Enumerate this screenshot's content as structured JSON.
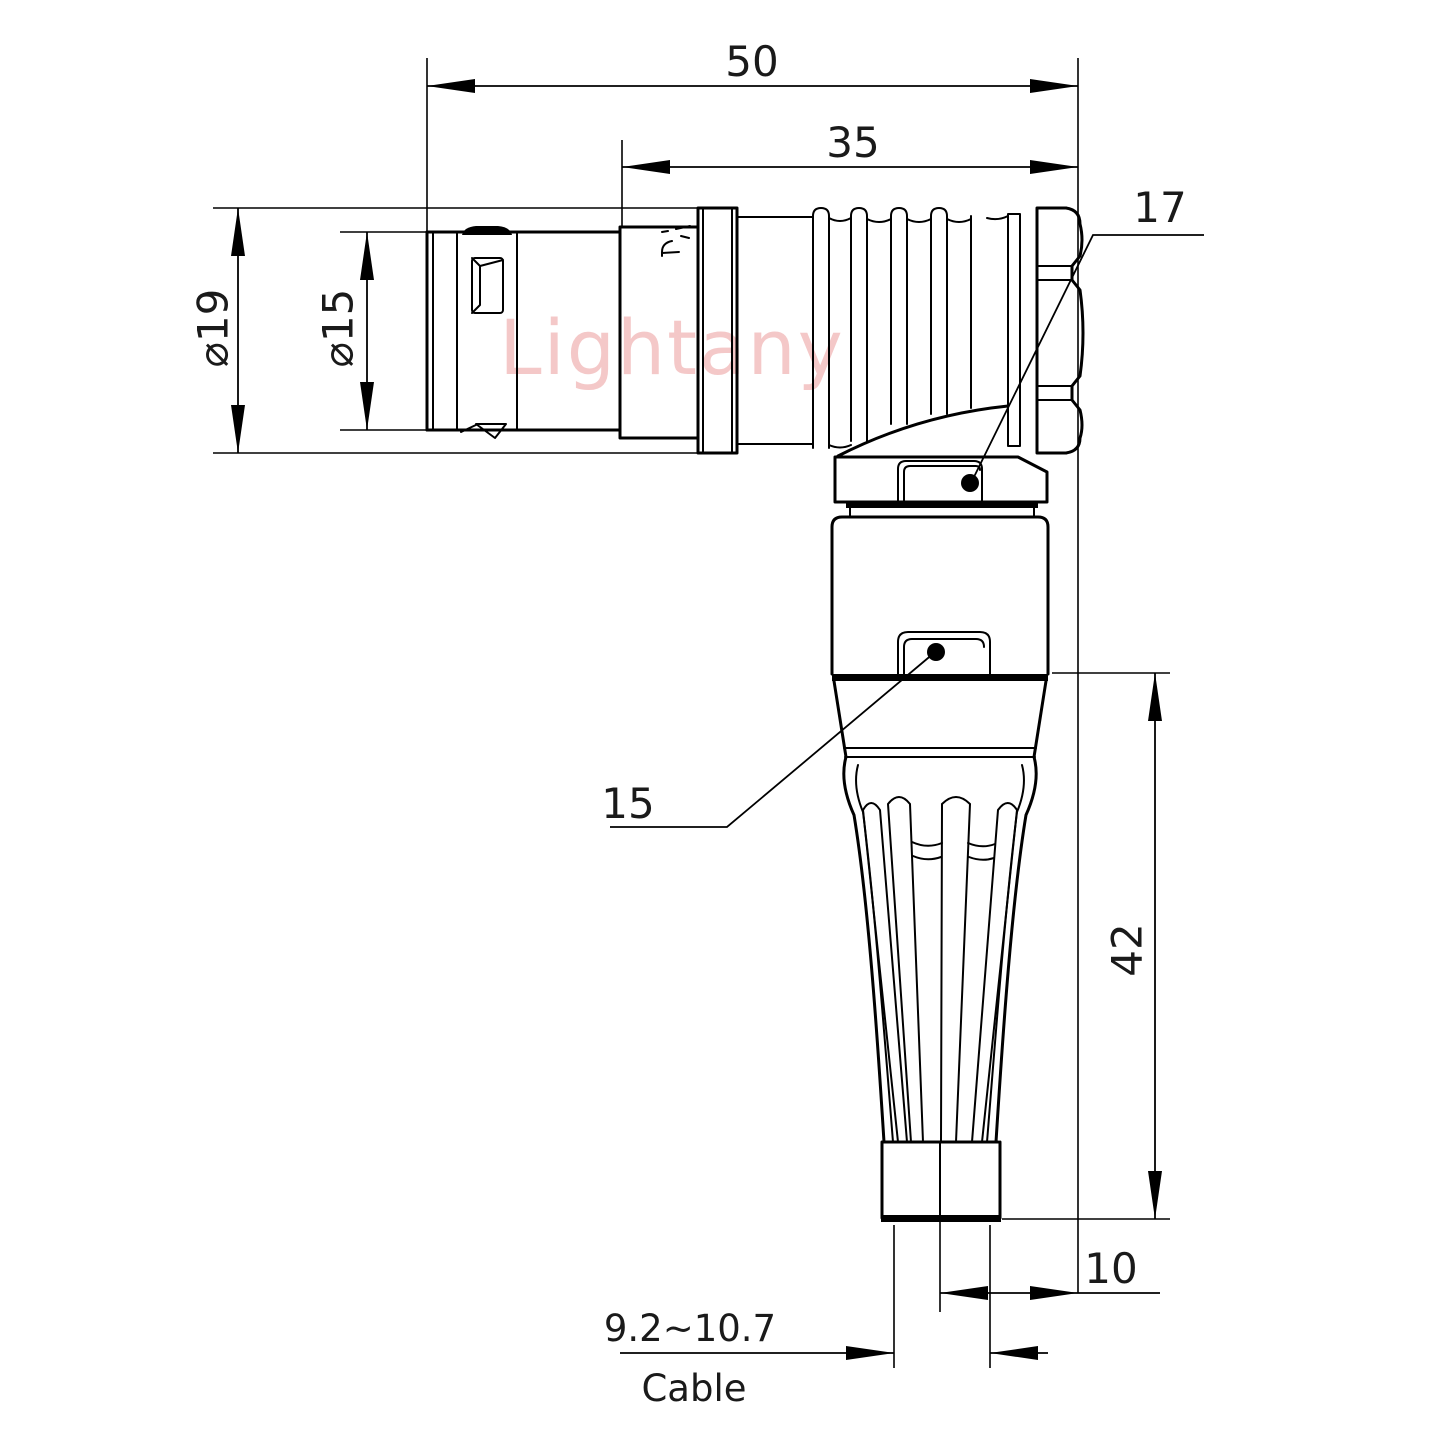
{
  "watermark": "Lightany",
  "colors": {
    "line": "#000000",
    "watermark": "#f4c8c8"
  },
  "dimensions": {
    "overall_length": "50",
    "rear_length": "35",
    "shell_diameter": "⌀19",
    "plug_diameter": "⌀15",
    "vertical_height": "42",
    "axis_offset": "10",
    "elbow_nut_size": "17",
    "body_nut_size": "15",
    "cable_range": "9.2~10.7",
    "cable_label": "Cable"
  }
}
